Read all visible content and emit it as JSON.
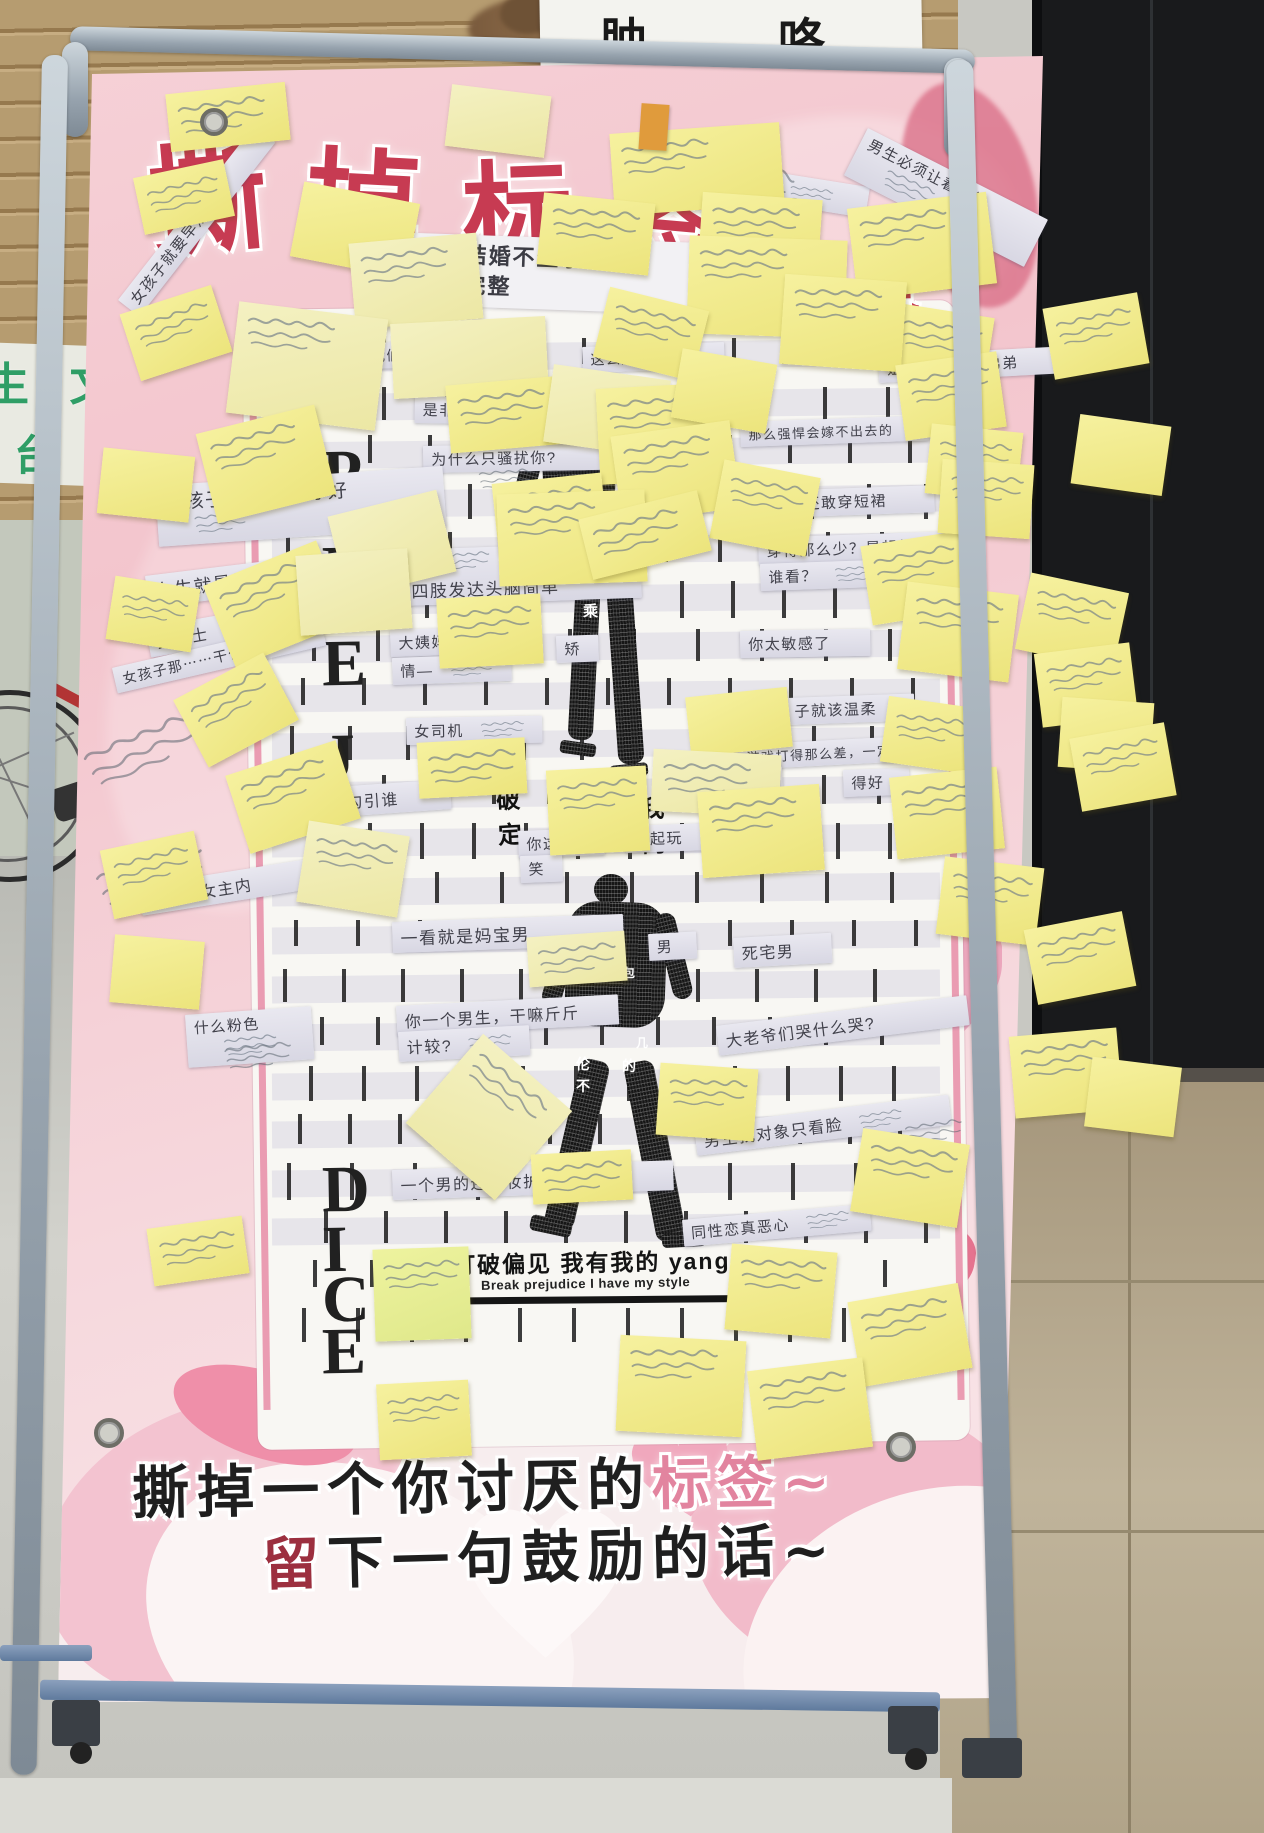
{
  "scene": {
    "wall_sign_text": "肿，咯",
    "green_sign_line1": "生 文",
    "green_sign_line2": "台"
  },
  "poster": {
    "title": "撕掉标签",
    "title_chars": [
      {
        "c": "撕",
        "x": 148,
        "y": 104,
        "s": 118,
        "r": -5
      },
      {
        "c": "掉",
        "x": 306,
        "y": 112,
        "s": 114,
        "r": 3
      },
      {
        "c": "标",
        "x": 462,
        "y": 124,
        "s": 110,
        "r": -2
      },
      {
        "c": "签",
        "x": 620,
        "y": 142,
        "s": 106,
        "r": 5
      }
    ],
    "subtitle_fragment": "的自己",
    "top_label": {
      "line1": "女人不结婚不生小孩",
      "line2": "生就不完整"
    },
    "mid_fragments": [
      {
        "t": "破定",
        "x": 497,
        "y": 780
      },
      {
        "t": "我的",
        "x": 641,
        "y": 789
      }
    ],
    "vertical_word": "PREJUDICE",
    "slogan_zh": "打破偏见  我有我的  yang",
    "slogan_en": "Break prejudice  I have my style",
    "bottom": {
      "line1_black": "撕掉一个你讨厌的",
      "line1_pink": "标签~",
      "line2_red": "留",
      "line2_black": "下一句鼓励的话~"
    },
    "labels": [
      {
        "t": "男的没一个好东西",
        "x": 622,
        "y": 148,
        "w": 235,
        "fs": 17,
        "r": 9,
        "hw": "r"
      },
      {
        "t": "男生必须让着女生",
        "x": 868,
        "y": 128,
        "w": 186,
        "fs": 15,
        "r": 27,
        "hw": "b"
      },
      {
        "t": "女孩子就要早点结婚",
        "x": 118,
        "y": 300,
        "w": 205,
        "fs": 15,
        "r": -52
      },
      {
        "t": "不好意思　我们不招女生",
        "x": 285,
        "y": 346,
        "w": 210,
        "fs": 14,
        "r": -2
      },
      {
        "t": "这么胖子还吃",
        "x": 582,
        "y": 347,
        "w": 126,
        "fs": 14,
        "r": -2
      },
      {
        "t": "姐姐应该让着弟弟",
        "x": 878,
        "y": 356,
        "w": 160,
        "fs": 15,
        "r": -3
      },
      {
        "t": "是非多",
        "x": 415,
        "y": 396,
        "w": 76,
        "fs": 15,
        "r": 1
      },
      {
        "t": "为什么只骚扰你?",
        "x": 423,
        "y": 446,
        "w": 168,
        "fs": 15,
        "r": -1
      },
      {
        "t": "那么强悍会嫁不出去的",
        "x": 740,
        "y": 422,
        "w": 172,
        "fs": 13,
        "r": -2
      },
      {
        "t": "女孩子一定要瘦才好",
        "x": 155,
        "y": 486,
        "w": 272,
        "fs": 19,
        "r": -4,
        "hw": "b"
      },
      {
        "t": "还敢穿短裙",
        "x": 796,
        "y": 490,
        "w": 122,
        "fs": 15,
        "r": -2
      },
      {
        "t": "穿得那么少？是想给",
        "x": 758,
        "y": 538,
        "w": 182,
        "fs": 15,
        "r": -2
      },
      {
        "t": "谁看？",
        "x": 760,
        "y": 564,
        "w": 68,
        "fs": 15,
        "r": -2,
        "hw": "r"
      },
      {
        "t": "四肢发达头脑简单",
        "x": 402,
        "y": 550,
        "w": 222,
        "fs": 17,
        "r": -2,
        "hw": "t"
      },
      {
        "t": "女生就是学不好理科",
        "x": 145,
        "y": 576,
        "w": 278,
        "fs": 18,
        "r": -7,
        "hw": "r"
      },
      {
        "t": "大姨妈",
        "x": 390,
        "y": 630,
        "w": 70,
        "fs": 15,
        "r": -2
      },
      {
        "t": "矫",
        "x": 556,
        "y": 636,
        "w": 26,
        "fs": 15,
        "r": -2
      },
      {
        "t": "情—",
        "x": 392,
        "y": 658,
        "w": 46,
        "fs": 15,
        "r": -2,
        "hw": "r"
      },
      {
        "t": "你太敏感了",
        "x": 740,
        "y": 631,
        "w": 114,
        "fs": 15,
        "r": -1
      },
      {
        "t": "女博士",
        "x": 146,
        "y": 628,
        "w": 76,
        "fs": 16,
        "r": -10,
        "hw": "r"
      },
      {
        "t": "女孩子那⋯⋯干什么",
        "x": 112,
        "y": 668,
        "w": 198,
        "fs": 14,
        "r": -13
      },
      {
        "t": "女司机",
        "x": 406,
        "y": 718,
        "w": 76,
        "fs": 15,
        "r": -1,
        "hw": "r"
      },
      {
        "t": "子就该温柔",
        "x": 786,
        "y": 698,
        "w": 112,
        "fs": 15,
        "r": -2
      },
      {
        "t": "游戏打得那么差，一定是女的",
        "x": 738,
        "y": 745,
        "w": 228,
        "fs": 13,
        "r": -3
      },
      {
        "t": "学",
        "x": 738,
        "y": 768,
        "w": 28,
        "fs": 15,
        "r": -2
      },
      {
        "t": "得好",
        "x": 843,
        "y": 770,
        "w": 50,
        "fs": 15,
        "r": -2
      },
      {
        "t": "穿成这样想勾引谁",
        "x": 250,
        "y": 793,
        "w": 184,
        "fs": 16,
        "r": -4
      },
      {
        "t": "你这人",
        "x": 518,
        "y": 831,
        "w": 70,
        "fs": 15,
        "r": -2
      },
      {
        "t": "不起玩",
        "x": 625,
        "y": 826,
        "w": 76,
        "fs": 15,
        "r": -2
      },
      {
        "t": "笑",
        "x": 520,
        "y": 856,
        "w": 26,
        "fs": 15,
        "r": -2
      },
      {
        "t": "男主外女主内",
        "x": 138,
        "y": 886,
        "w": 172,
        "fs": 16,
        "r": -9
      },
      {
        "t": "一看就是妈宝男",
        "x": 392,
        "y": 922,
        "w": 215,
        "fs": 17,
        "r": -2
      },
      {
        "t": "死宅男",
        "x": 733,
        "y": 938,
        "w": 82,
        "fs": 16,
        "r": -3
      },
      {
        "t": "男",
        "x": 648,
        "y": 934,
        "w": 32,
        "fs": 15,
        "r": -3
      },
      {
        "t": "什么粉色",
        "x": 185,
        "y": 1015,
        "w": 96,
        "fs": 15,
        "r": -4,
        "hw": "b"
      },
      {
        "t": "你一个男生，干嘛斤斤",
        "x": 396,
        "y": 1006,
        "w": 206,
        "fs": 16,
        "r": -3
      },
      {
        "t": "计较?",
        "x": 398,
        "y": 1032,
        "w": 54,
        "fs": 16,
        "r": -3,
        "hw": "r"
      },
      {
        "t": "大老爷们哭什么哭?",
        "x": 716,
        "y": 1026,
        "w": 236,
        "fs": 16,
        "r": -7
      },
      {
        "t": "男生找对象只看脸",
        "x": 694,
        "y": 1126,
        "w": 240,
        "fs": 16,
        "r": -7,
        "hw": "r"
      },
      {
        "t": "一个男的还化妆护肤?",
        "x": 392,
        "y": 1170,
        "w": 265,
        "fs": 16,
        "r": -2
      },
      {
        "t": "同性恋真恶心",
        "x": 682,
        "y": 1220,
        "w": 172,
        "fs": 15,
        "r": -5,
        "hw": "r"
      }
    ],
    "figure_glyphs": [
      {
        "t": "经",
        "x": 594,
        "y": 556,
        "s": 11
      },
      {
        "t": "乘",
        "x": 583,
        "y": 600,
        "s": 15
      },
      {
        "t": "包",
        "x": 623,
        "y": 964,
        "s": 12
      },
      {
        "t": "几",
        "x": 636,
        "y": 1034,
        "s": 12
      },
      {
        "t": "伦",
        "x": 576,
        "y": 1054,
        "s": 14
      },
      {
        "t": "的",
        "x": 622,
        "y": 1056,
        "s": 14
      },
      {
        "t": "不",
        "x": 576,
        "y": 1076,
        "s": 14
      }
    ]
  },
  "sticky_notes": {
    "color": "#f3ee96",
    "count": 71,
    "writing": "illegible handwriting"
  }
}
